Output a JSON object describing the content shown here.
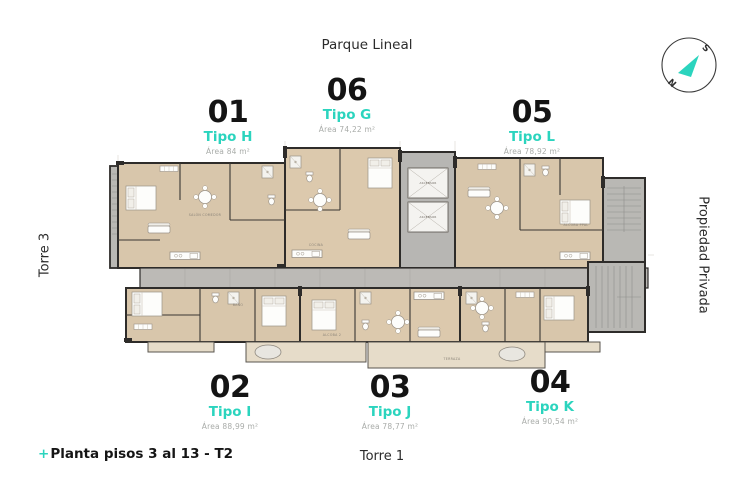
{
  "page": {
    "top_label": "Parque Lineal",
    "bottom_center_label": "Torre 1",
    "left_side_label": "Torre 3",
    "right_side_label": "Propiedad Privada",
    "footer": {
      "plus": "+",
      "label": "Planta pisos 3 al 13 - T2"
    }
  },
  "compass": {
    "south": "S",
    "north": "N"
  },
  "units": [
    {
      "number": "01",
      "tipo": "Tipo H",
      "area": "Área 84 m²"
    },
    {
      "number": "06",
      "tipo": "Tipo G",
      "area": "Área 74,22 m²"
    },
    {
      "number": "05",
      "tipo": "Tipo L",
      "area": "Área 78,92 m²"
    },
    {
      "number": "02",
      "tipo": "Tipo I",
      "area": "Área 88,99 m²"
    },
    {
      "number": "03",
      "tipo": "Tipo J",
      "area": "Área 78,77 m²"
    },
    {
      "number": "04",
      "tipo": "Tipo K",
      "area": "Área 90,54 m²"
    }
  ],
  "plan": {
    "room_labels": {
      "ascensor": "ASCENSOR",
      "salon_comedor": "SALÓN COMEDOR",
      "cocina": "COCINA",
      "alcoba_ppal": "ALCOBA PPAL",
      "alcoba_2": "ALCOBA 2",
      "bano": "BAÑO",
      "terraza": "TERRAZA"
    }
  },
  "colors": {
    "accent": "#2bd4be",
    "ink": "#1d1d1d",
    "muted": "#a9aca9",
    "wall": "#2e2c2a",
    "floor": "#d8c6ab",
    "floor_light": "#e6dcc9",
    "concrete": "#bcbab6"
  }
}
